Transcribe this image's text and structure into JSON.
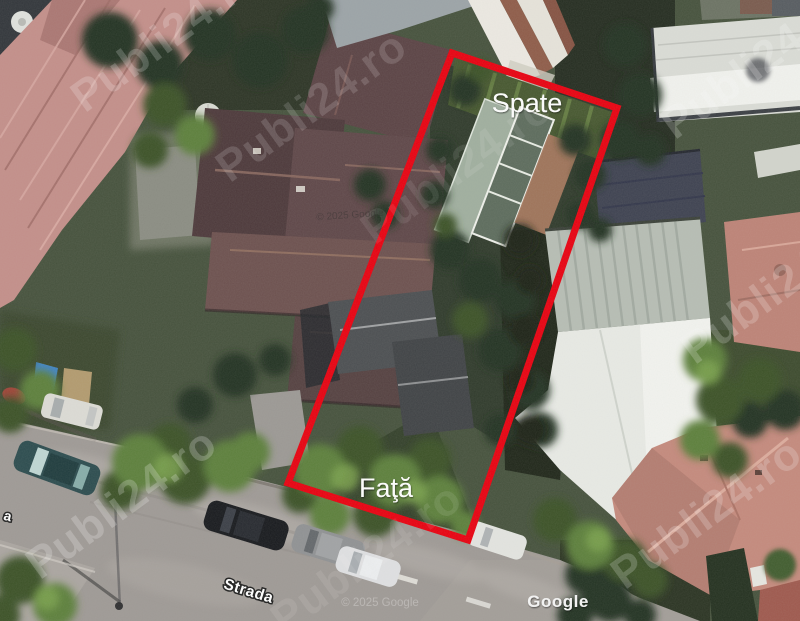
{
  "labels": {
    "back": "Spate",
    "front": "Faţă"
  },
  "street": {
    "name": "Strada",
    "partial_name": "a"
  },
  "attribution": {
    "provider": "Google",
    "copyright": "© 2025 Google"
  },
  "watermark": {
    "text": "Publi24.ro"
  },
  "colors": {
    "outline_red": "#e8000f",
    "label_white": "#ffffff"
  }
}
